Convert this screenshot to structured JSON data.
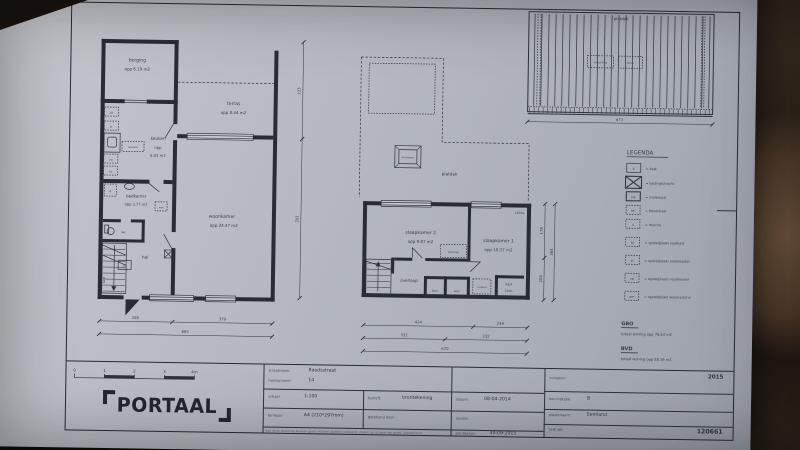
{
  "photo": {
    "paper": "#b7bbc3",
    "ink": "#2d323b",
    "background": "#1c1611"
  },
  "ground_floor": {
    "berging": {
      "name": "berging",
      "area": "opp 6.19 m2"
    },
    "terras": {
      "name": "terras",
      "area": "opp 8.44 m2"
    },
    "keuken": {
      "name": "keuken",
      "area1": "opp",
      "area2": "6.03 m2"
    },
    "badkamer": {
      "name": "badkamer",
      "area": "opp 3.77 m2"
    },
    "woonkamer": {
      "name": "woonkamer",
      "area": "opp 24.47 m2"
    },
    "hal": "hal",
    "wc": "wc",
    "kast": "kast",
    "fixtures": {
      "bk": "bk",
      "kt": "kt",
      "vw": "vw",
      "kk": "kk",
      "mk": "mk",
      "wm": "wm",
      "d": "d",
      "aanrecht": "aanrecht"
    },
    "dims": {
      "w1": "269",
      "w2": "379",
      "w_total": "665",
      "h1": "223",
      "h2": "291"
    }
  },
  "first_floor": {
    "slaapkamer2": {
      "name": "slaapkamer 2",
      "area": "opp 9.87 m2"
    },
    "slaapkamer1": {
      "name": "slaapkamer 1",
      "area": "opp 10.37 m2"
    },
    "overloop": "overloop",
    "kast1": "kast",
    "kast2": "kast",
    "kast3": "kast",
    "vlizotrap": "vlizotrap",
    "cv": "cv-ketel",
    "platdak": "platdak",
    "lichtkoepel": "lichtkoepel",
    "sill_top": "1500+",
    "sill_bottom": "1500-",
    "dims": {
      "w1": "424",
      "w2": "239",
      "w3": "332",
      "w4": "332",
      "w_total": "670",
      "h1": "178",
      "h2": "206",
      "h_total": "384"
    }
  },
  "roof_plan": {
    "label": "platdak",
    "vent1": "ontluchting",
    "vent2": "afvoer",
    "dim": "673"
  },
  "legend": {
    "title": "LEGENDA",
    "items": [
      {
        "sym": "k",
        "text": "= kast"
      },
      {
        "sym": "",
        "text": "= leidingschacht"
      },
      {
        "sym": "mk",
        "text": "= meterkast"
      },
      {
        "sym": "bk",
        "text": "= bovenkast"
      },
      {
        "sym": "d",
        "text": "= douche"
      },
      {
        "sym": "kk",
        "text": "= opstelplaats koelkast"
      },
      {
        "sym": "kt",
        "text": "= opstelplaats kooktoestel"
      },
      {
        "sym": "vw",
        "text": "= opstelplaats vaatwasser"
      },
      {
        "sym": "wm",
        "text": "= opstelplaats wasmachine"
      }
    ]
  },
  "totals": {
    "gbo_title": "GBO",
    "gbo_text": "totaal woning opp 78.63 m2",
    "bvd_title": "BVD",
    "bvd_text": "totaal woning opp 88.16 m2"
  },
  "title_block": {
    "street_label": "straatnaam:",
    "street": "Raadsstraat",
    "number_label": "huisnummer",
    "number": "14",
    "scale_label": "schaal",
    "scale": "1:100",
    "format_label": "formaat",
    "format": "A4 (210*297mm)",
    "subject_label": "betreft:",
    "subject": "brontekening",
    "drawn_label": "getekend door:",
    "date_label": "datum:",
    "date": "08-04-2014",
    "revision_label": "revisie:",
    "print_label": "printdatum",
    "print_date": "30-09-2015",
    "complex_label": "complex:",
    "complex_value": "2015",
    "type_label": "woningtype:",
    "type_value": "B",
    "place_label": "plaatsnaam:",
    "place_value": "Eemland",
    "vhe_label": "VHE-NR:",
    "vhe_value": "120661",
    "disclaimer": "aan deze tekening kunnen geen rechten worden ontleend, maten en uitvoering onder voorbehoud",
    "logo_text": "PORTAAL",
    "scalebar": [
      "0",
      "1",
      "2",
      "3",
      "4m"
    ]
  }
}
